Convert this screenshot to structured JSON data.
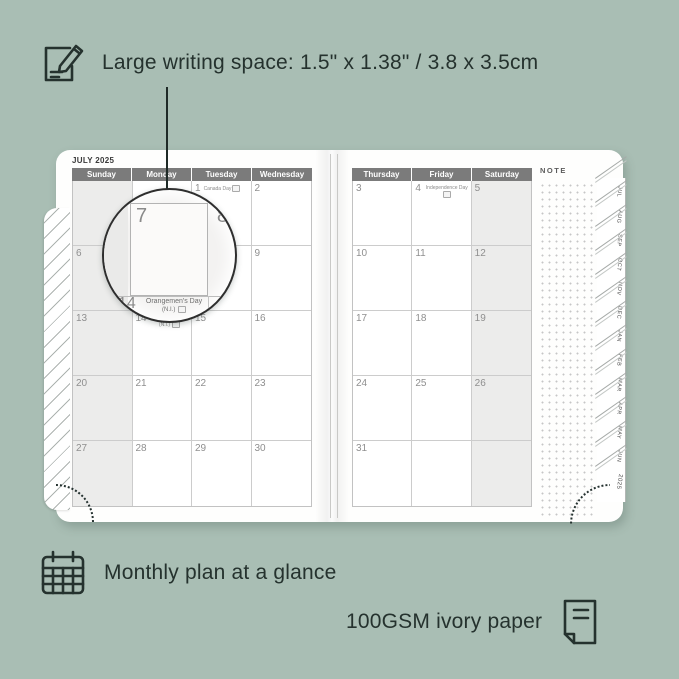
{
  "colors": {
    "background": "#a9beb4",
    "annotation_text": "#25322e",
    "header_bar": "#7b7b7b",
    "shaded_cell": "#ececeb",
    "page": "#fefefd"
  },
  "top_annotation": {
    "label": "Large writing space: 1.5\" x 1.38\" / 3.8 x 3.5cm"
  },
  "bottom_annotations": {
    "monthly": "Monthly plan at a glance",
    "paper": "100GSM ivory paper"
  },
  "planner": {
    "month_title": "JULY 2025",
    "note_label": "NOTE",
    "left_page": {
      "headers": [
        "Sunday",
        "Monday",
        "Tuesday",
        "Wednesday"
      ],
      "shaded_column": 0,
      "rows": [
        [
          {},
          {},
          {
            "d": "1",
            "h": "Canada Day",
            "flag": true
          },
          {
            "d": "2"
          }
        ],
        [
          {
            "d": "6"
          },
          {
            "d": "7"
          },
          {
            "d": "8"
          },
          {
            "d": "9"
          }
        ],
        [
          {
            "d": "13"
          },
          {
            "d": "14",
            "h": "Orangemen's Day",
            "h2": "(N.I.)",
            "flag": true
          },
          {
            "d": "15"
          },
          {
            "d": "16"
          }
        ],
        [
          {
            "d": "20"
          },
          {
            "d": "21"
          },
          {
            "d": "22"
          },
          {
            "d": "23"
          }
        ],
        [
          {
            "d": "27"
          },
          {
            "d": "28"
          },
          {
            "d": "29"
          },
          {
            "d": "30"
          }
        ]
      ]
    },
    "right_page": {
      "headers": [
        "Thursday",
        "Friday",
        "Saturday"
      ],
      "shaded_column": 2,
      "rows": [
        [
          {
            "d": "3"
          },
          {
            "d": "4",
            "h": "Independence Day",
            "flag": true
          },
          {
            "d": "5"
          }
        ],
        [
          {
            "d": "10"
          },
          {
            "d": "11"
          },
          {
            "d": "12"
          }
        ],
        [
          {
            "d": "17"
          },
          {
            "d": "18"
          },
          {
            "d": "19"
          }
        ],
        [
          {
            "d": "24"
          },
          {
            "d": "25"
          },
          {
            "d": "26"
          }
        ],
        [
          {
            "d": "31"
          },
          {},
          {}
        ]
      ]
    },
    "tabs": [
      "JUL",
      "AUG",
      "SEP",
      "OCT",
      "NOV",
      "DEC",
      "JAN",
      "FEB",
      "MAR",
      "APR",
      "MAY",
      "JUN"
    ],
    "year_tab": "2025",
    "magnifier": {
      "day": "7",
      "next_day": "8",
      "below_day": "14",
      "below_holiday": "Orangemen's Day",
      "below_region": "(N.I.)"
    }
  }
}
